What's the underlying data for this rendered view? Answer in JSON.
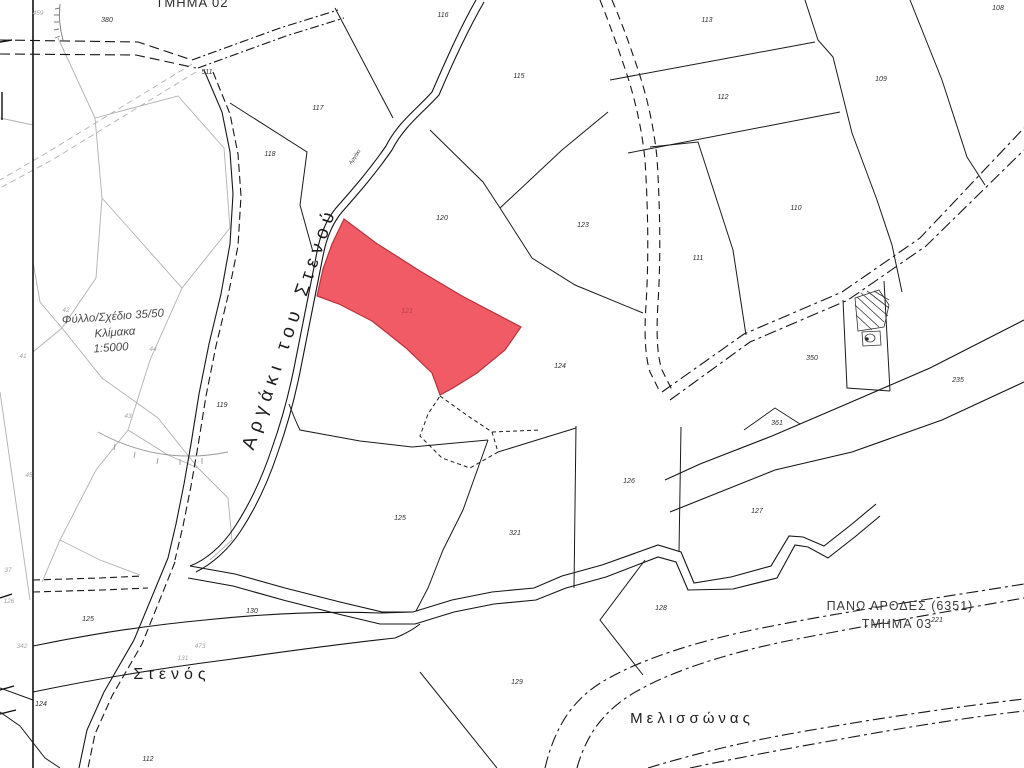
{
  "labels": {
    "tmima_top": "ΤΜΗΜΑ 02",
    "sheet_line1": "Φύλλο/Σχέδιο 35/50",
    "sheet_line2": "Κλίμακα",
    "sheet_line3": "1:5000",
    "village_line1": "ΠΑΝΩ ΑΡΟΔΕΣ (6351)",
    "village_line2": "ΤΜΗΜΑ 03"
  },
  "names": {
    "stream": "Αργάκι του Στενού",
    "stream_small": "Αργάκι",
    "stenos": "Στενός",
    "melissonas": "Μελισσώνας"
  },
  "highlight": {
    "number": "121",
    "fill": "#F15B66",
    "stroke": "#B5333F"
  },
  "colors": {
    "boundary": "#1a1a1a",
    "adjacent_sheet": "#a3a3a3"
  },
  "parcel_numbers": [
    "380",
    "511",
    "116",
    "115",
    "117",
    "118",
    "120",
    "123",
    "113",
    "112",
    "109",
    "108",
    "110",
    "111",
    "119",
    "124",
    "350",
    "235",
    "361",
    "126",
    "127",
    "125",
    "321",
    "128",
    "129",
    "130",
    "125",
    "124",
    "112",
    "221"
  ],
  "adjacent_numbers": [
    "459",
    "42",
    "41",
    "44",
    "43",
    "45",
    "37",
    "342",
    "473",
    "131",
    "126"
  ]
}
